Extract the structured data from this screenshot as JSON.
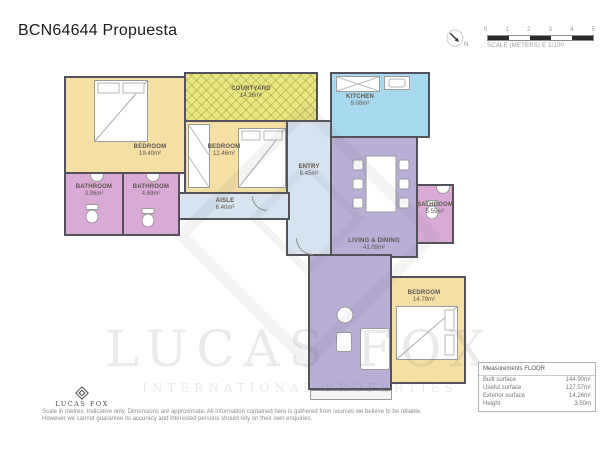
{
  "page": {
    "title": "BCN64644 Propuesta"
  },
  "scale_bar": {
    "ticks": [
      "0",
      "1",
      "2",
      "3",
      "4",
      "5"
    ],
    "label": "SCALE (METERS) E 1/100",
    "north_label": "N"
  },
  "rooms": [
    {
      "id": "bedroom-1",
      "label": "BEDROOM",
      "area": "19.40m²"
    },
    {
      "id": "bedroom-2",
      "label": "BEDROOM",
      "area": "12.46m²"
    },
    {
      "id": "courtyard",
      "label": "COURTYARD",
      "area": "14.26m²"
    },
    {
      "id": "kitchen",
      "label": "KITCHEN",
      "area": "9.08m²"
    },
    {
      "id": "entry",
      "label": "ENTRY",
      "area": "6.45m²"
    },
    {
      "id": "aisle",
      "label": "AISLE",
      "area": "6.40m²"
    },
    {
      "id": "bathroom-1",
      "label": "BATHROOM",
      "area": "3.96m²"
    },
    {
      "id": "bathroom-2",
      "label": "BATHROOM",
      "area": "4.69m²"
    },
    {
      "id": "bathroom-3",
      "label": "BATHROOM",
      "area": "5.55m²"
    },
    {
      "id": "living-dining",
      "label": "LIVING & DINING",
      "area": "41.09m²"
    },
    {
      "id": "bedroom-4",
      "label": "BEDROOM",
      "area": "14.79m²"
    }
  ],
  "watermark": {
    "brand": "LUCAS FOX",
    "tagline": "INTERNATIONAL PROPERTIES"
  },
  "footer": {
    "brand": "LUCAS FOX",
    "disclaimer_line1": "Scale in metres. Indicative only. Dimensions are approximate. All information contained here is gathered from sources we believe to be reliable.",
    "disclaimer_line2": "However we cannot guarantee its accuracy and interested persons should rely on their own enquiries."
  },
  "measurements": {
    "header": "Measurements FLOOR",
    "rows": [
      {
        "label": "Built surface",
        "value": "144.90m²"
      },
      {
        "label": "Useful surface",
        "value": "127.57m²"
      },
      {
        "label": "Exterior surface",
        "value": "14.26m²"
      },
      {
        "label": "Height",
        "value": "3.50m"
      }
    ]
  },
  "colors": {
    "bedroom": "#f4dfa4",
    "courtyard": "#eae783",
    "kitchen": "#a9d9ee",
    "hall": "#d7e3ee",
    "bathroom": "#d9abd4",
    "living": "#b9aed6",
    "wall": "#53525a"
  }
}
